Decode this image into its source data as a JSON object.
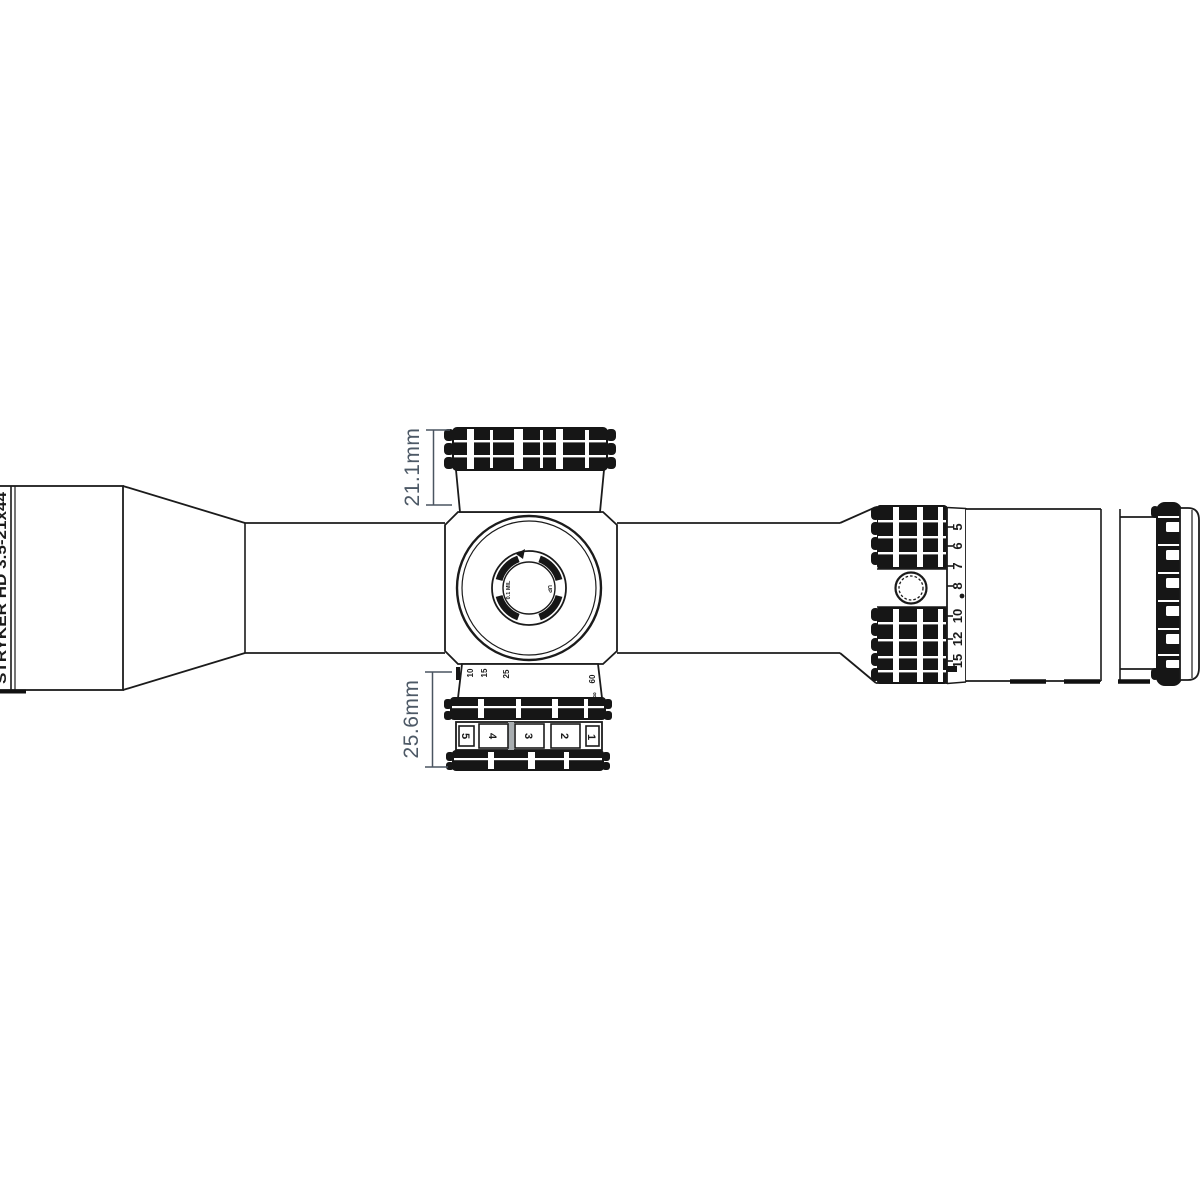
{
  "diagram": {
    "kind": "riflescope top-view technical drawing",
    "model_label": "STRYKER HD 3.5-21x44",
    "dimensions": {
      "top_knob_height": "21.1mm",
      "bottom_knob_height": "25.6mm"
    },
    "magnification_scale": {
      "numbers": [
        "5",
        "6",
        "7",
        "8",
        "10",
        "12",
        "15"
      ],
      "nine_marker": "dot"
    },
    "turret_cap": {
      "click_value_label": "0.1 MIL",
      "direction_label": "UP"
    },
    "windage_scale": {
      "digits": [
        "5",
        "4",
        "3",
        "2",
        "1"
      ]
    },
    "distance_scale": {
      "left_marks": [
        "10",
        "15",
        "25"
      ],
      "right_marks": [
        "60",
        "∞"
      ]
    },
    "colors": {
      "line": "#1b1b1b",
      "knurl_fill": "#161616",
      "dimension_text": "#4d5966",
      "background": "#ffffff"
    }
  }
}
